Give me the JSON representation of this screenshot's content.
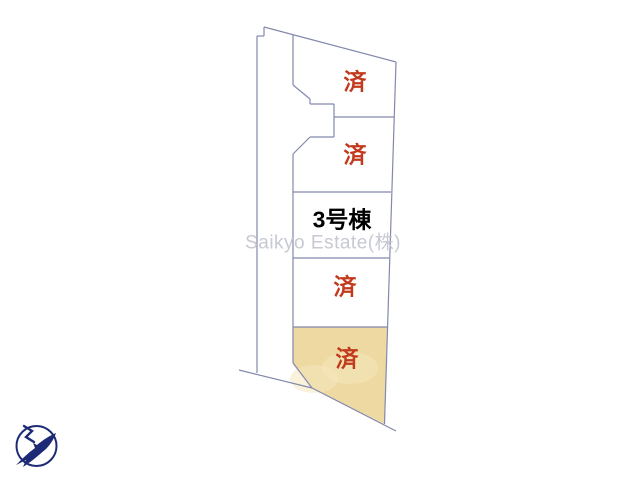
{
  "canvas": {
    "width": 640,
    "height": 480,
    "background": "#ffffff"
  },
  "site_plan": {
    "line_color": "#8289ac",
    "sold_mark_color": "#c23a1d",
    "building_label_color": "#000000",
    "sold_lot_fill": "#edd9a1",
    "sold_lot_highlight": "#f6e8bd",
    "lots": [
      {
        "id": "lot-top-1",
        "status_label": "済",
        "sold": true
      },
      {
        "id": "lot-top-2",
        "status_label": "済",
        "sold": true
      },
      {
        "id": "lot-building-3",
        "name_label": "3号棟",
        "sold": false
      },
      {
        "id": "lot-mid",
        "status_label": "済",
        "sold": true
      },
      {
        "id": "lot-bottom",
        "status_label": "済",
        "sold": true,
        "highlighted": true
      }
    ],
    "geometry": {
      "segments": [
        [
          257,
          36,
          257,
          373
        ],
        [
          257,
          36,
          264,
          36
        ],
        [
          264,
          36,
          264,
          27
        ],
        [
          264,
          27,
          396,
          62
        ],
        [
          396,
          62,
          384.5,
          424
        ],
        [
          293,
          35,
          293,
          85
        ],
        [
          293,
          85,
          310,
          99
        ],
        [
          310,
          99,
          310,
          104
        ],
        [
          310,
          104,
          334,
          104
        ],
        [
          334,
          104,
          334,
          137
        ],
        [
          334,
          117,
          394,
          117
        ],
        [
          334,
          137,
          310,
          137
        ],
        [
          310,
          137,
          293,
          154
        ],
        [
          293,
          154,
          293,
          363
        ],
        [
          293,
          192,
          391,
          192
        ],
        [
          293,
          258,
          389,
          258
        ],
        [
          293,
          327,
          387,
          327
        ],
        [
          293,
          363,
          312,
          388
        ],
        [
          312,
          388,
          396,
          431
        ],
        [
          239,
          370,
          312,
          388
        ]
      ],
      "sold_polygon": "293,327 387,327 384.5,424 312,388 293,363",
      "highlight_spots": [
        [
          314,
          379,
          24,
          14
        ],
        [
          350,
          368,
          28,
          16
        ]
      ]
    }
  },
  "labels": {
    "lot1_status": "済",
    "lot2_status": "済",
    "lot3_name": "3号棟",
    "lot4_status": "済",
    "lot5_status": "済"
  },
  "watermark": {
    "text": "Saikyo Estate(株)",
    "color": "#c5c7d1"
  },
  "compass": {
    "name": "north-compass",
    "color": "#1d2b76"
  }
}
